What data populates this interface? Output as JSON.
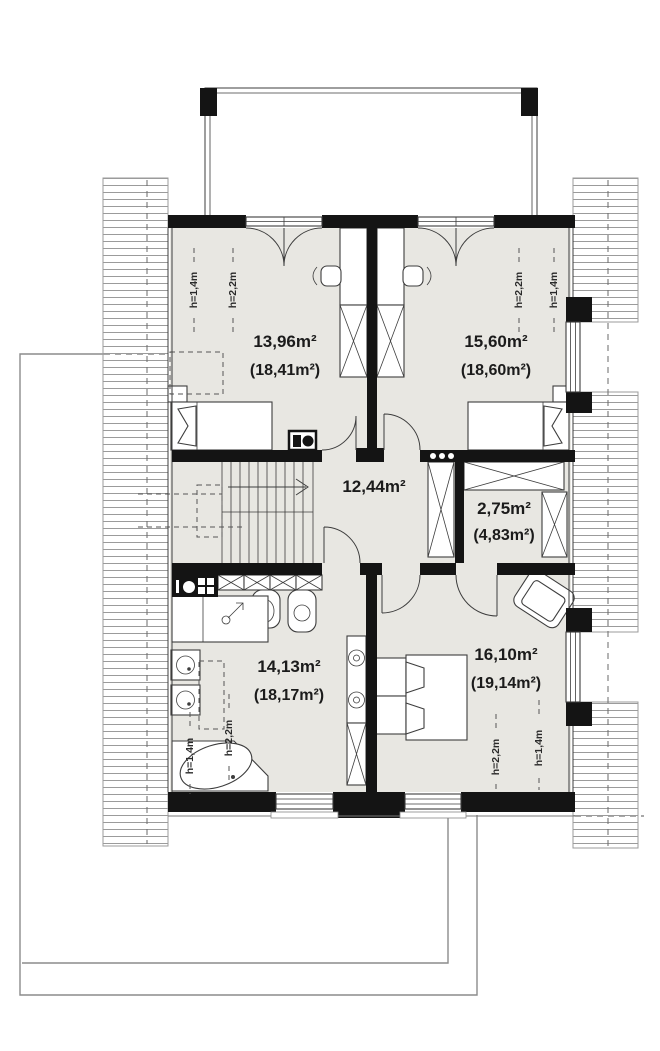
{
  "plan": {
    "title": "attic-floor-plan",
    "rooms": [
      {
        "name": "bedroom-top-left",
        "area": "13,96m²",
        "area_total": "(18,41m²)"
      },
      {
        "name": "bedroom-top-right",
        "area": "15,60m²",
        "area_total": "(18,60m²)"
      },
      {
        "name": "hall",
        "area": "12,44m²",
        "area_total": ""
      },
      {
        "name": "wardrobe",
        "area": "2,75m²",
        "area_total": "(4,83m²)"
      },
      {
        "name": "bathroom",
        "area": "14,13m²",
        "area_total": "(18,17m²)"
      },
      {
        "name": "bedroom-bottom-right",
        "area": "16,10m²",
        "area_total": "(19,14m²)"
      }
    ],
    "height_marks": {
      "low": "h=1,4m",
      "high": "h=2,2m"
    },
    "colors": {
      "wall": "#141414",
      "line": "#3d3d3d",
      "floor": "#e8e7e2",
      "hatch": "#9b9b9b",
      "outline": "#8b8b8b"
    }
  }
}
